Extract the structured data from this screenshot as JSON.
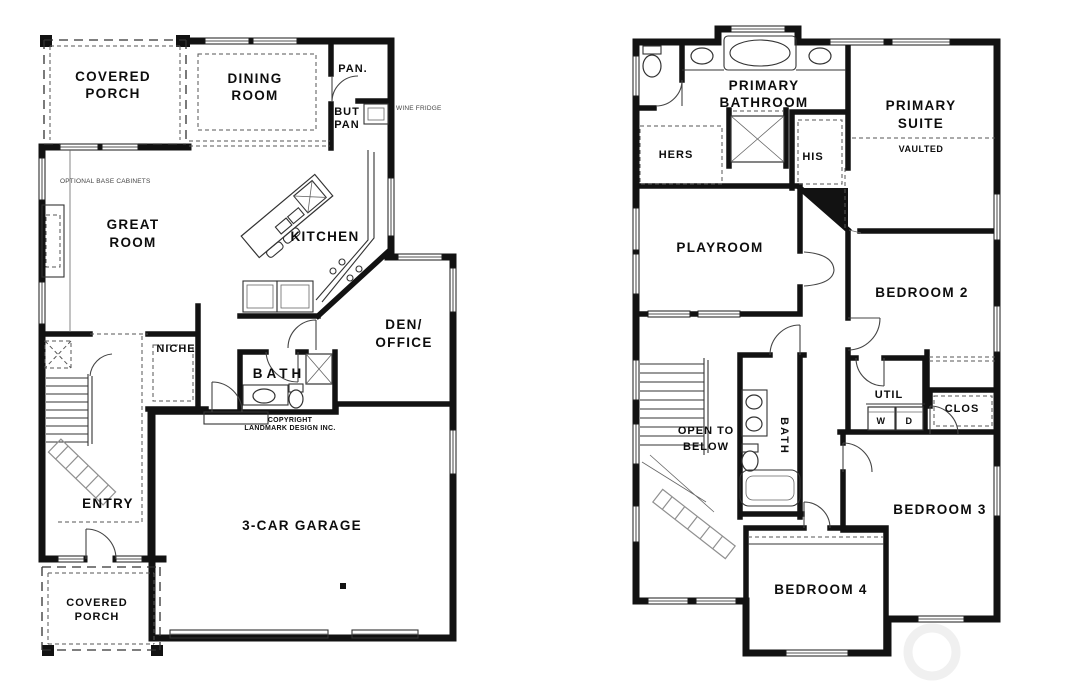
{
  "style": {
    "background": "#ffffff",
    "wall_color": "#121212",
    "line_color": "#333333",
    "dash_color": "#555555",
    "label_color": "#0d0d0d",
    "watermark_color": "#f0f0f0"
  },
  "first_floor": {
    "labels": {
      "covered_porch_top_1": "COVERED",
      "covered_porch_top_2": "PORCH",
      "dining_1": "DINING",
      "dining_2": "ROOM",
      "pantry": "PAN.",
      "butlers_1": "BUT",
      "butlers_2": "PAN",
      "wine_fridge": "WINE FRIDGE",
      "optional_cabinets": "OPTIONAL BASE CABINETS",
      "great_1": "GREAT",
      "great_2": "ROOM",
      "kitchen": "KITCHEN",
      "niche": "NICHE",
      "den_1": "DEN/",
      "den_2": "OFFICE",
      "bath": "BATH",
      "copyright_1": "COPYRIGHT",
      "copyright_2": "LANDMARK DESIGN INC.",
      "entry": "ENTRY",
      "garage": "3-CAR GARAGE",
      "covered_porch_bottom_1": "COVERED",
      "covered_porch_bottom_2": "PORCH"
    }
  },
  "second_floor": {
    "labels": {
      "primary_bath_1": "PRIMARY",
      "primary_bath_2": "BATHROOM",
      "hers": "HERS",
      "his": "HIS",
      "primary_suite_1": "PRIMARY",
      "primary_suite_2": "SUITE",
      "vaulted": "VAULTED",
      "playroom": "PLAYROOM",
      "bedroom2": "BEDROOM 2",
      "util": "UTIL",
      "washer": "W",
      "dryer": "D",
      "clos": "CLOS",
      "open_below_1": "OPEN TO",
      "open_below_2": "BELOW",
      "bath": "BATH",
      "bedroom3": "BEDROOM 3",
      "bedroom4": "BEDROOM 4"
    }
  }
}
